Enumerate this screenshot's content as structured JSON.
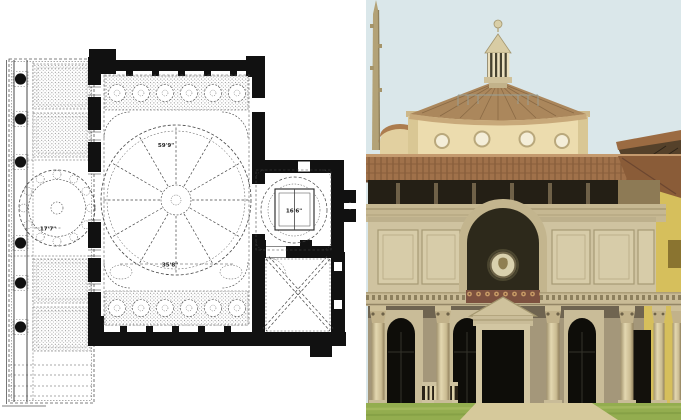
{
  "page": {
    "background": "#ffffff"
  },
  "figures": {
    "floor_plan": {
      "ink": "#141414",
      "labels": {
        "nave_dome": "59'9\"",
        "nave_width": "35'8\"",
        "porch_dome": "17'7\"",
        "scarsella": "16'6\""
      }
    },
    "photo": {
      "colors": {
        "sky": "#dae7ea",
        "cone": "#ab875c",
        "drum": "#ecdcae",
        "roof_tile": "#a0714a",
        "shadow_band": "#241f15",
        "stone": "#cfc3a0",
        "stone_dark": "#a4977a",
        "opening": "#0e0d09",
        "yellow_wall": "#d6bf5c",
        "frieze": "#7d513f",
        "medallion": "#d9d1ae",
        "lawn": "#93ad4f",
        "path": "#d6c99b"
      }
    }
  }
}
